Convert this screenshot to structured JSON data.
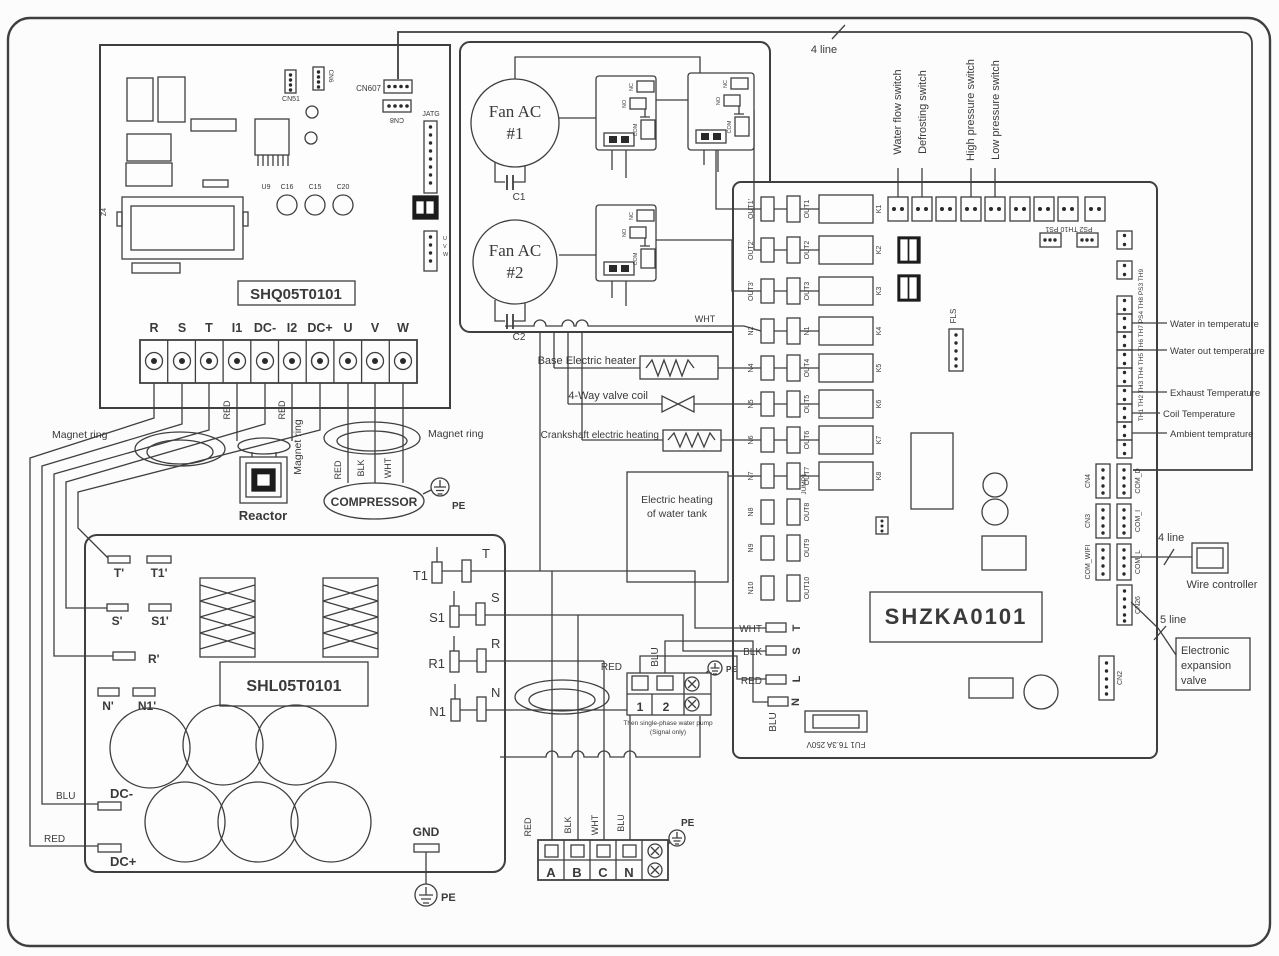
{
  "labels": {
    "magnet_ring": "Magnet ring",
    "reactor": "Reactor",
    "compressor": "COMPRESSOR",
    "pe": "PE",
    "gnd": "GND",
    "red": "RED",
    "blk": "BLK",
    "wht": "WHT",
    "blu": "BLU",
    "four_line": "4 line",
    "five_line": "5 line",
    "wire_controller": "Wire controller",
    "dc_minus": "DC-",
    "dc_plus": "DC+"
  },
  "shq": {
    "name": "SHQ05T0101",
    "cn51": "CN51",
    "cn6": "CN6",
    "cn607": "CN607",
    "cn8": "CN8",
    "jatg": "JATG",
    "u9": "U9",
    "c16": "C16",
    "c15": "C15",
    "c20": "C20",
    "z4": "Z4",
    "u": "U",
    "v": "V",
    "w": "W",
    "terminals": [
      "R",
      "S",
      "T",
      "I1",
      "DC-",
      "I2",
      "DC+",
      "U",
      "V",
      "W"
    ]
  },
  "fans": {
    "label": "Fan AC",
    "n1": "#1",
    "n2": "#2",
    "c1": "C1",
    "c2": "C2"
  },
  "relay": {
    "nc": "NC",
    "no": "NO",
    "com": "COM"
  },
  "main": {
    "name": "SHZKA0101",
    "rows": [
      {
        "o": "OUT1'",
        "i": "OUT1"
      },
      {
        "o": "OUT2'",
        "i": "OUT2"
      },
      {
        "o": "OUT3'",
        "i": "OUT3"
      },
      {
        "o": "N2",
        "i": "N1"
      },
      {
        "o": "N4",
        "i": "OUT4"
      },
      {
        "o": "N5",
        "i": "OUT5"
      },
      {
        "o": "N6",
        "i": "OUT6"
      },
      {
        "o": "N7",
        "i": "OUT7"
      },
      {
        "o": "N8",
        "i": "OUT8"
      },
      {
        "o": "N9",
        "i": "OUT9"
      },
      {
        "o": "N10",
        "i": "OUT10"
      }
    ],
    "relays": [
      "K1",
      "K2",
      "K3",
      "K4",
      "K5",
      "K6",
      "K7",
      "K8"
    ],
    "fls": "FLS",
    "ps_row": "PS2 TH10 PS1",
    "sensor_col": "TH1 TH2 TH3 TH4 TH5 TH6 TH7 PS4 TH8 PS3 TH9",
    "jump": "JUMP1",
    "fuse": "FU1 T6.3A 250V",
    "t": "T",
    "s": "S",
    "l": "L",
    "n": "N",
    "cn4": "CN4",
    "cn3": "CN3",
    "com_wifi": "COM_WIFI",
    "com_d": "COM_D",
    "com_i": "COM_I",
    "com_l": "COM_L",
    "cn26": "CN26",
    "cn2": "CN2"
  },
  "switches": [
    "Water flow switch",
    "Defrosting switch",
    "High pressure switch",
    "Low pressure switch"
  ],
  "sensors": [
    "Water in temperature",
    "Water out temperature",
    "Exhaust Temperature",
    "Coil Temperature",
    "Ambient temprature"
  ],
  "loads": {
    "base": "Base Electric heater",
    "valve": "4-Way valve coil",
    "crank": "Crankshaft electric heating",
    "tank1": "Electric heating",
    "tank2": "of water tank"
  },
  "shl": {
    "name": "SHL05T0101",
    "t": "T'",
    "t1": "T1'",
    "s": "S'",
    "s1": "S1'",
    "r": "R'",
    "n": "N'",
    "n1": "N1'"
  },
  "pump": {
    "n1": "1",
    "n2": "2",
    "cap1": "Then single-phase water pump",
    "cap2": "(Signal only)"
  },
  "fuses": [
    {
      "l": "T1",
      "r": "T"
    },
    {
      "l": "S1",
      "r": "S"
    },
    {
      "l": "R1",
      "r": "R"
    },
    {
      "l": "N1",
      "r": "N"
    }
  ],
  "abcn": [
    "A",
    "B",
    "C",
    "N"
  ],
  "eev": [
    "Electronic",
    "expansion",
    "valve"
  ]
}
